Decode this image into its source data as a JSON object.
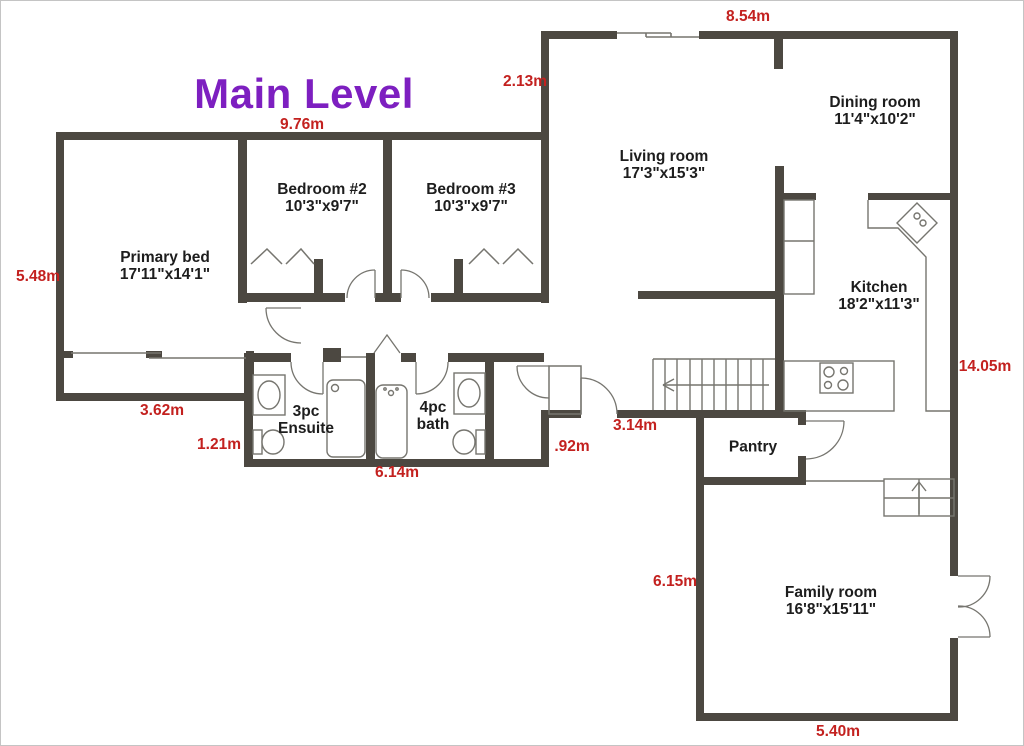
{
  "title": {
    "text": "Main Level"
  },
  "colors": {
    "wall": "#4c4841",
    "thin_line": "#76756f",
    "measurement_red": "#c3211f",
    "title_purple": "#7d1fc0",
    "label_black": "#1d1d1d"
  },
  "measurements": [
    {
      "id": "top-width",
      "text": "8.54m"
    },
    {
      "id": "living-left",
      "text": "2.13m"
    },
    {
      "id": "bedroom-wing-top",
      "text": "9.76m"
    },
    {
      "id": "left-height",
      "text": "5.48m"
    },
    {
      "id": "bay-bottom",
      "text": "3.62m"
    },
    {
      "id": "ensuite-left",
      "text": "1.21m"
    },
    {
      "id": "bath-bottom",
      "text": "6.14m"
    },
    {
      "id": "nook-width",
      "text": ".92m"
    },
    {
      "id": "hall-bottom",
      "text": "3.14m"
    },
    {
      "id": "right-height",
      "text": "14.05m"
    },
    {
      "id": "family-left",
      "text": "6.15m"
    },
    {
      "id": "family-bottom",
      "text": "5.40m"
    }
  ],
  "rooms": [
    {
      "id": "primary-bed",
      "name": "Primary bed",
      "dims": "17'11\"x14'1\""
    },
    {
      "id": "bedroom-2",
      "name": "Bedroom #2",
      "dims": "10'3\"x9'7\""
    },
    {
      "id": "bedroom-3",
      "name": "Bedroom #3",
      "dims": "10'3\"x9'7\""
    },
    {
      "id": "living-room",
      "name": "Living room",
      "dims": "17'3\"x15'3\""
    },
    {
      "id": "dining-room",
      "name": "Dining room",
      "dims": "11'4\"x10'2\""
    },
    {
      "id": "kitchen",
      "name": "Kitchen",
      "dims": "18'2\"x11'3\""
    },
    {
      "id": "ensuite",
      "name": "3pc",
      "dims": "Ensuite"
    },
    {
      "id": "bath",
      "name": "4pc",
      "dims": "bath"
    },
    {
      "id": "pantry",
      "name": "Pantry",
      "dims": ""
    },
    {
      "id": "family-room",
      "name": "Family room",
      "dims": "16'8\"x15'11\""
    }
  ]
}
